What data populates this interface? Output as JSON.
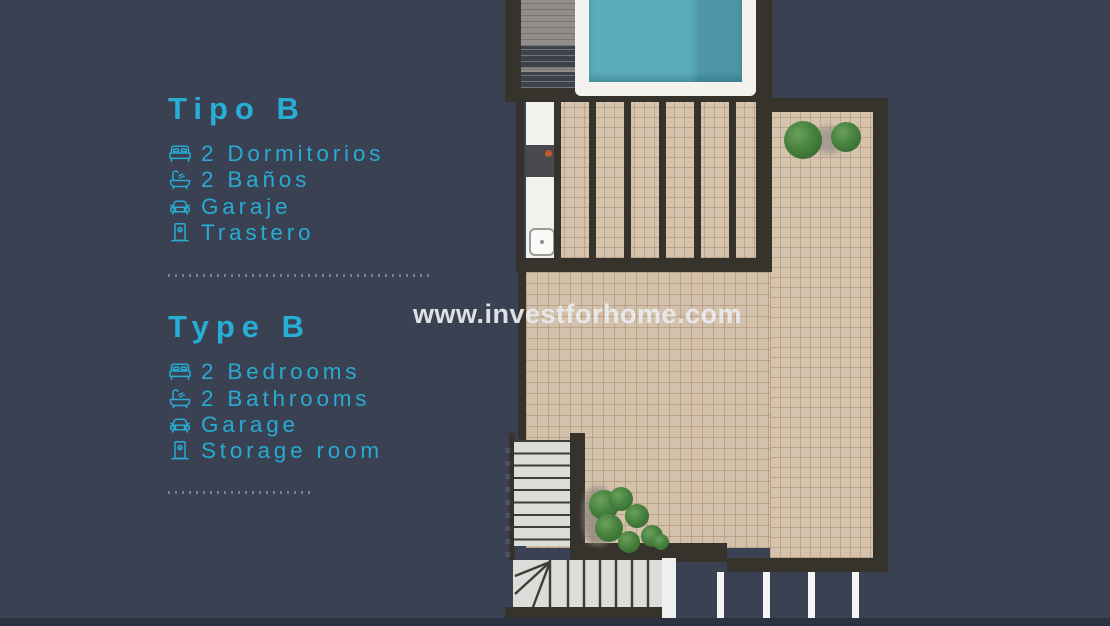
{
  "info_panel": {
    "sections": [
      {
        "title": "Tipo B",
        "items": [
          {
            "icon": "bed-icon",
            "label": "2 Dormitorios"
          },
          {
            "icon": "bath-icon",
            "label": "2 Baños"
          },
          {
            "icon": "car-icon",
            "label": "Garaje"
          },
          {
            "icon": "door-icon",
            "label": "Trastero"
          }
        ]
      },
      {
        "title": "Type B",
        "items": [
          {
            "icon": "bed-icon",
            "label": "2 Bedrooms"
          },
          {
            "icon": "bath-icon",
            "label": "2 Bathrooms"
          },
          {
            "icon": "car-icon",
            "label": "Garage"
          },
          {
            "icon": "door-icon",
            "label": "Storage room"
          }
        ]
      }
    ]
  },
  "watermark": {
    "text": "www.investforhome.com"
  },
  "colors": {
    "background": "#3a4153",
    "accent_cyan": "#28abd1",
    "wall": "#36322c",
    "tile": "#d4c1ac",
    "pool_water": "#5badbc",
    "watermark_text": "#e9eaec"
  },
  "floorplan": {
    "areas": [
      "swimming-pool",
      "wood-deck",
      "pergola-terrace",
      "outdoor-kitchen",
      "roof-terrace",
      "plants",
      "staircase",
      "railing"
    ]
  }
}
